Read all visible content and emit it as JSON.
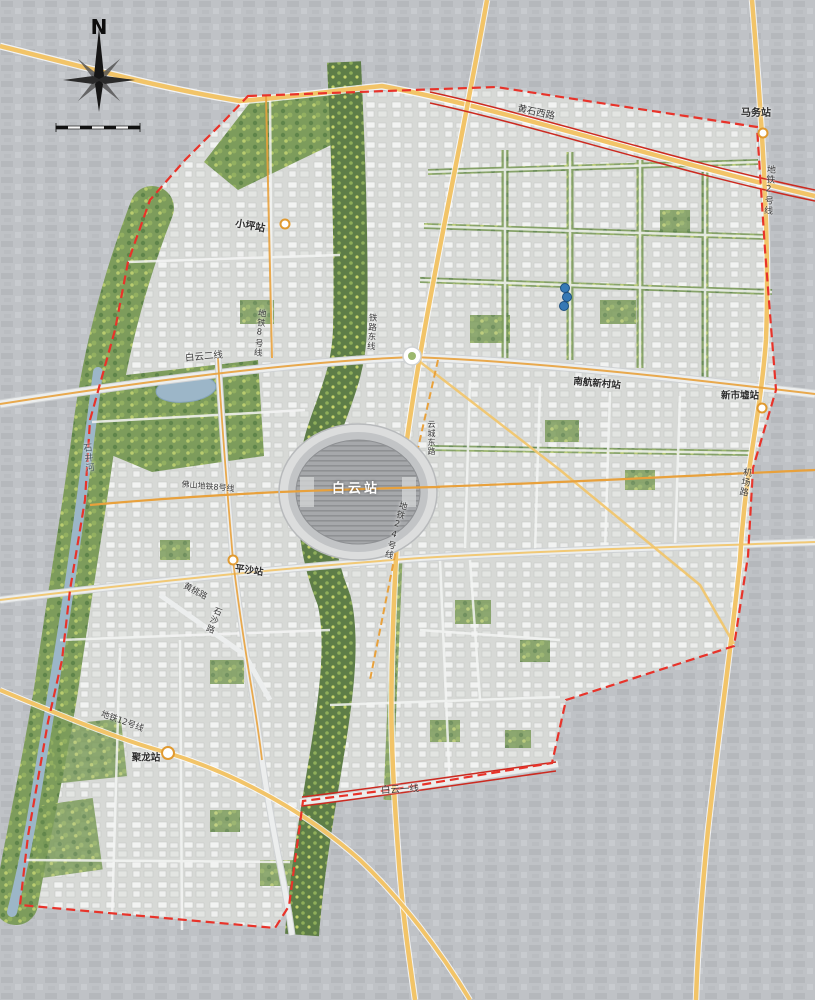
{
  "map_title": "白云站片区规划总图",
  "compass": {
    "north": "N"
  },
  "labels": [
    {
      "text": "N",
      "type": "compass"
    },
    {
      "text": "黄石西路",
      "type": "road"
    },
    {
      "text": "马务站",
      "type": "station"
    },
    {
      "text": "地铁2号线",
      "type": "metro-line"
    },
    {
      "text": "小坪站",
      "type": "station"
    },
    {
      "text": "地铁8号线",
      "type": "metro-line"
    },
    {
      "text": "铁路东线",
      "type": "railway"
    },
    {
      "text": "白云二线",
      "type": "road"
    },
    {
      "text": "南航新村站",
      "type": "station"
    },
    {
      "text": "新市墟站",
      "type": "station"
    },
    {
      "text": "石井河",
      "type": "river"
    },
    {
      "text": "佛山地铁8号线",
      "type": "metro-line"
    },
    {
      "text": "白云站",
      "type": "station-main"
    },
    {
      "text": "地铁24号线",
      "type": "metro-line"
    },
    {
      "text": "机场路",
      "type": "road"
    },
    {
      "text": "平沙站",
      "type": "station"
    },
    {
      "text": "黄桃路",
      "type": "road"
    },
    {
      "text": "石沙路",
      "type": "road"
    },
    {
      "text": "地铁12号线",
      "type": "metro-line"
    },
    {
      "text": "聚龙站",
      "type": "station"
    },
    {
      "text": "白云一线",
      "type": "road"
    },
    {
      "text": "云城东路",
      "type": "road"
    }
  ],
  "stations": [
    "白云站",
    "马务站",
    "小坪站",
    "南航新村站",
    "新市墟站",
    "平沙站",
    "聚龙站"
  ],
  "metro_lines": [
    "地铁2号线",
    "地铁8号线",
    "地铁12号线",
    "地铁24号线",
    "佛山地铁8号线"
  ],
  "roads": [
    "黄石西路",
    "白云一线",
    "白云二线",
    "机场路",
    "黄桃路",
    "石沙路",
    "云城东路"
  ],
  "water": [
    "石井河"
  ],
  "railway": [
    "铁路东线"
  ],
  "colors": {
    "boundary_red": "#e8332a",
    "brt_red": "#cc2a20",
    "road_yellow": "#f2c468",
    "metro_orange": "#e8a13c",
    "water_blue": "#9cb6c8",
    "green_trees": "#7d9c5c",
    "rail_green": "#5e7d48",
    "station_gray": "#a6a8ab",
    "city_inside": "#d7d9d6",
    "city_outside": "#bfc2c6",
    "marker_dot_blue": "#3679b5"
  }
}
